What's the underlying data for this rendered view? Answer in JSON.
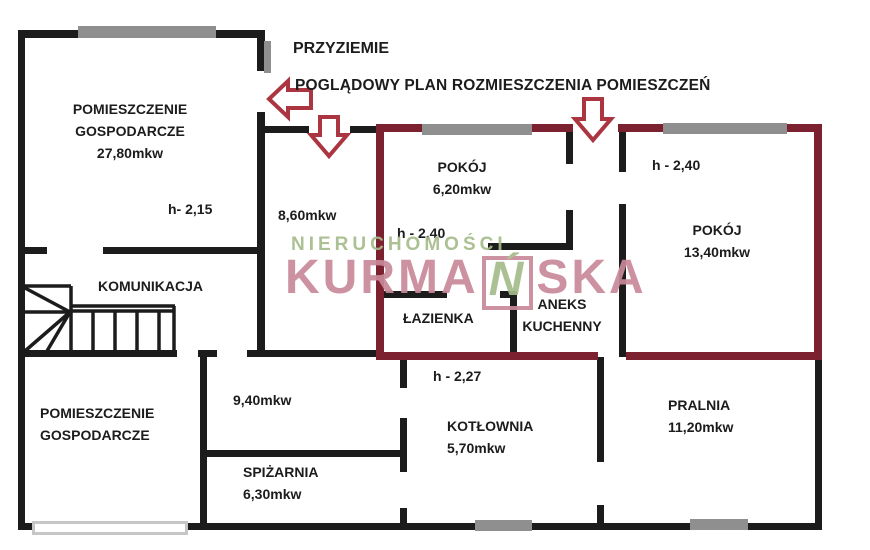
{
  "canvas": {
    "width": 870,
    "height": 550,
    "background": "#ffffff"
  },
  "titles": {
    "floor": "PRZYZIEMIE",
    "subtitle": "POGLĄDOWY PLAN ROZMIESZCZENIA POMIESZCZEŃ"
  },
  "watermark": {
    "top_line": "NIERUCHOMOŚCI",
    "brand_prefix": "KURMA",
    "brand_boxed_letter": "Ń",
    "brand_suffix": "SKA"
  },
  "colors": {
    "wall": "#1c1c1c",
    "unit_outline": "#7b2130",
    "arrow": "#ab3540",
    "window_dark": "#8f8f8f",
    "window_light_border": "#c6c6c6",
    "watermark_green": "#a6bc8a",
    "watermark_pink": "#c9899a",
    "text": "#1c1c1c"
  },
  "labels": [
    {
      "id": "room-gospodarcze-top",
      "lines": [
        "POMIESZCZENIE",
        "GOSPODARCZE",
        "27,80mkw"
      ],
      "x": 130,
      "y": 98,
      "align": "center"
    },
    {
      "id": "height-2-15",
      "lines": [
        "h- 2,15"
      ],
      "x": 168,
      "y": 198,
      "align": "left"
    },
    {
      "id": "room-komunikacja",
      "lines": [
        "KOMUNIKACJA"
      ],
      "x": 98,
      "y": 275,
      "align": "left"
    },
    {
      "id": "area-8-60",
      "lines": [
        "8,60mkw"
      ],
      "x": 278,
      "y": 204,
      "align": "left"
    },
    {
      "id": "room-pokoj-6-20",
      "lines": [
        "POKÓJ",
        "6,20mkw"
      ],
      "x": 462,
      "y": 156,
      "align": "center"
    },
    {
      "id": "height-2-40-left",
      "lines": [
        "h - 2,40"
      ],
      "x": 397,
      "y": 222,
      "align": "left"
    },
    {
      "id": "height-2-40-right",
      "lines": [
        "h - 2,40"
      ],
      "x": 652,
      "y": 154,
      "align": "left"
    },
    {
      "id": "room-pokoj-13-40",
      "lines": [
        "POKÓJ",
        "13,40mkw"
      ],
      "x": 717,
      "y": 219,
      "align": "center"
    },
    {
      "id": "room-lazienka",
      "lines": [
        "ŁAZIENKA"
      ],
      "x": 403,
      "y": 307,
      "align": "left"
    },
    {
      "id": "room-aneks-kuchenny",
      "lines": [
        "ANEKS",
        "KUCHENNY"
      ],
      "x": 562,
      "y": 293,
      "align": "center"
    },
    {
      "id": "room-gospodarcze-bottom",
      "lines": [
        "POMIESZCZENIE",
        "GOSPODARCZE"
      ],
      "x": 40,
      "y": 402,
      "align": "left"
    },
    {
      "id": "area-9-40",
      "lines": [
        "9,40mkw"
      ],
      "x": 233,
      "y": 389,
      "align": "left"
    },
    {
      "id": "height-2-27",
      "lines": [
        "h - 2,27"
      ],
      "x": 433,
      "y": 365,
      "align": "left"
    },
    {
      "id": "room-kotlownia",
      "lines": [
        "KOTŁOWNIA",
        "5,70mkw"
      ],
      "x": 447,
      "y": 415,
      "align": "left"
    },
    {
      "id": "room-spizarnia",
      "lines": [
        "SPIŻARNIA",
        "6,30mkw"
      ],
      "x": 243,
      "y": 461,
      "align": "left"
    },
    {
      "id": "room-pralnia",
      "lines": [
        "PRALNIA",
        "11,20mkw"
      ],
      "x": 668,
      "y": 394,
      "align": "left"
    }
  ],
  "floorplan": {
    "walls": [
      {
        "n": "wall-topleft-room-top",
        "x": 18,
        "y": 30,
        "w": 244,
        "h": 8,
        "c": "wall"
      },
      {
        "n": "wall-outer-left",
        "x": 18,
        "y": 30,
        "w": 7,
        "h": 500,
        "c": "wall"
      },
      {
        "n": "wall-topleft-room-right-a",
        "x": 257,
        "y": 30,
        "w": 8,
        "h": 41,
        "c": "wall"
      },
      {
        "n": "wall-topleft-room-right-b",
        "x": 257,
        "y": 112,
        "w": 8,
        "h": 245,
        "c": "wall"
      },
      {
        "n": "wall-topleft-room-bottom-a",
        "x": 25,
        "y": 247,
        "w": 22,
        "h": 7,
        "c": "wall"
      },
      {
        "n": "wall-topleft-room-bottom-b",
        "x": 103,
        "y": 247,
        "w": 159,
        "h": 7,
        "c": "wall"
      },
      {
        "n": "wall-hall-top-a",
        "x": 262,
        "y": 126,
        "w": 47,
        "h": 7,
        "c": "wall"
      },
      {
        "n": "wall-hall-top-b",
        "x": 350,
        "y": 126,
        "w": 27,
        "h": 7,
        "c": "wall"
      },
      {
        "n": "wall-mid-a",
        "x": 18,
        "y": 350,
        "w": 159,
        "h": 7,
        "c": "wall"
      },
      {
        "n": "wall-mid-b",
        "x": 198,
        "y": 350,
        "w": 19,
        "h": 7,
        "c": "wall"
      },
      {
        "n": "wall-mid-c",
        "x": 247,
        "y": 350,
        "w": 130,
        "h": 7,
        "c": "wall"
      },
      {
        "n": "wall-bottomleft-room-right",
        "x": 200,
        "y": 350,
        "w": 7,
        "h": 180,
        "c": "wall"
      },
      {
        "n": "wall-spizarnia-top",
        "x": 207,
        "y": 450,
        "w": 196,
        "h": 7,
        "c": "wall"
      },
      {
        "n": "wall-kotlownia-left-a",
        "x": 400,
        "y": 357,
        "w": 7,
        "h": 31,
        "c": "wall"
      },
      {
        "n": "wall-kotlownia-left-b",
        "x": 400,
        "y": 418,
        "w": 7,
        "h": 54,
        "c": "wall"
      },
      {
        "n": "wall-kotlownia-left-c",
        "x": 400,
        "y": 508,
        "w": 7,
        "h": 22,
        "c": "wall"
      },
      {
        "n": "wall-kotlownia-right-a",
        "x": 597,
        "y": 357,
        "w": 7,
        "h": 105,
        "c": "wall"
      },
      {
        "n": "wall-kotlownia-right-b",
        "x": 597,
        "y": 505,
        "w": 7,
        "h": 25,
        "c": "wall"
      },
      {
        "n": "wall-outer-bottom",
        "x": 18,
        "y": 523,
        "w": 804,
        "h": 7,
        "c": "wall"
      },
      {
        "n": "wall-outer-right-lower",
        "x": 815,
        "y": 357,
        "w": 7,
        "h": 173,
        "c": "wall"
      },
      {
        "n": "wall-pokoj620-right-a",
        "x": 566,
        "y": 126,
        "w": 7,
        "h": 38,
        "c": "wall"
      },
      {
        "n": "wall-pokoj620-right-b",
        "x": 566,
        "y": 210,
        "w": 7,
        "h": 40,
        "c": "wall"
      },
      {
        "n": "wall-nook",
        "x": 488,
        "y": 243,
        "w": 85,
        "h": 7,
        "c": "wall"
      },
      {
        "n": "wall-pokoj1340-left-a",
        "x": 619,
        "y": 126,
        "w": 7,
        "h": 46,
        "c": "wall"
      },
      {
        "n": "wall-pokoj1340-left-b",
        "x": 619,
        "y": 204,
        "w": 7,
        "h": 153,
        "c": "wall"
      },
      {
        "n": "wall-lazienka-top-a",
        "x": 380,
        "y": 291,
        "w": 67,
        "h": 7,
        "c": "wall"
      },
      {
        "n": "wall-lazienka-top-b",
        "x": 500,
        "y": 291,
        "w": 13,
        "h": 7,
        "c": "wall"
      },
      {
        "n": "wall-lazienka-right",
        "x": 510,
        "y": 291,
        "w": 7,
        "h": 66,
        "c": "wall"
      },
      {
        "n": "wall-unit-left",
        "x": 376,
        "y": 124,
        "w": 8,
        "h": 236,
        "c": "unit_outline"
      },
      {
        "n": "wall-unit-top-a",
        "x": 376,
        "y": 124,
        "w": 197,
        "h": 8,
        "c": "unit_outline"
      },
      {
        "n": "wall-unit-top-b",
        "x": 618,
        "y": 124,
        "w": 204,
        "h": 8,
        "c": "unit_outline"
      },
      {
        "n": "wall-unit-right",
        "x": 814,
        "y": 124,
        "w": 8,
        "h": 236,
        "c": "unit_outline"
      },
      {
        "n": "wall-unit-bottom-a",
        "x": 376,
        "y": 352,
        "w": 222,
        "h": 8,
        "c": "unit_outline"
      },
      {
        "n": "wall-unit-bottom-b",
        "x": 626,
        "y": 352,
        "w": 196,
        "h": 8,
        "c": "unit_outline"
      }
    ],
    "windows": [
      {
        "n": "window-topleft-top",
        "x": 78,
        "y": 26,
        "w": 138,
        "h": 12,
        "t": "dark"
      },
      {
        "n": "window-topleft-right",
        "x": 264,
        "y": 41,
        "w": 7,
        "h": 32,
        "t": "dark"
      },
      {
        "n": "window-pokoj620-top",
        "x": 422,
        "y": 124,
        "w": 110,
        "h": 11,
        "t": "dark"
      },
      {
        "n": "window-pokoj1340-top",
        "x": 663,
        "y": 123,
        "w": 124,
        "h": 11,
        "t": "dark"
      },
      {
        "n": "window-kotlownia-bottom",
        "x": 475,
        "y": 520,
        "w": 57,
        "h": 11,
        "t": "dark"
      },
      {
        "n": "window-pralnia-bottom",
        "x": 690,
        "y": 519,
        "w": 58,
        "h": 11,
        "t": "dark"
      },
      {
        "n": "window-bottomleft",
        "x": 32,
        "y": 521,
        "w": 156,
        "h": 14,
        "t": "light"
      }
    ],
    "arrows": [
      {
        "n": "entrance-arrow-left",
        "points": "311,90 288,90 288,81 269,99 288,117 288,108 311,108"
      },
      {
        "n": "entrance-arrow-down-small",
        "points": "320,117 338,117 338,135 347,135 329,156 311,135 320,135"
      },
      {
        "n": "entrance-arrow-down-big",
        "points": "584,99 602,99 602,119 611,119 593,140 575,119 584,119"
      }
    ],
    "stairs_lines": [
      [
        25,
        286,
        71,
        286
      ],
      [
        71,
        286,
        71,
        352
      ],
      [
        25,
        312,
        71,
        312
      ],
      [
        70,
        312,
        25,
        288
      ],
      [
        70,
        312,
        25,
        351
      ],
      [
        70,
        312,
        47,
        351
      ],
      [
        71,
        306,
        175,
        306
      ],
      [
        71,
        311,
        175,
        311
      ],
      [
        174,
        306,
        174,
        351
      ],
      [
        93,
        311,
        93,
        351
      ],
      [
        115,
        311,
        115,
        351
      ],
      [
        137,
        311,
        137,
        351
      ],
      [
        159,
        311,
        159,
        351
      ]
    ]
  }
}
